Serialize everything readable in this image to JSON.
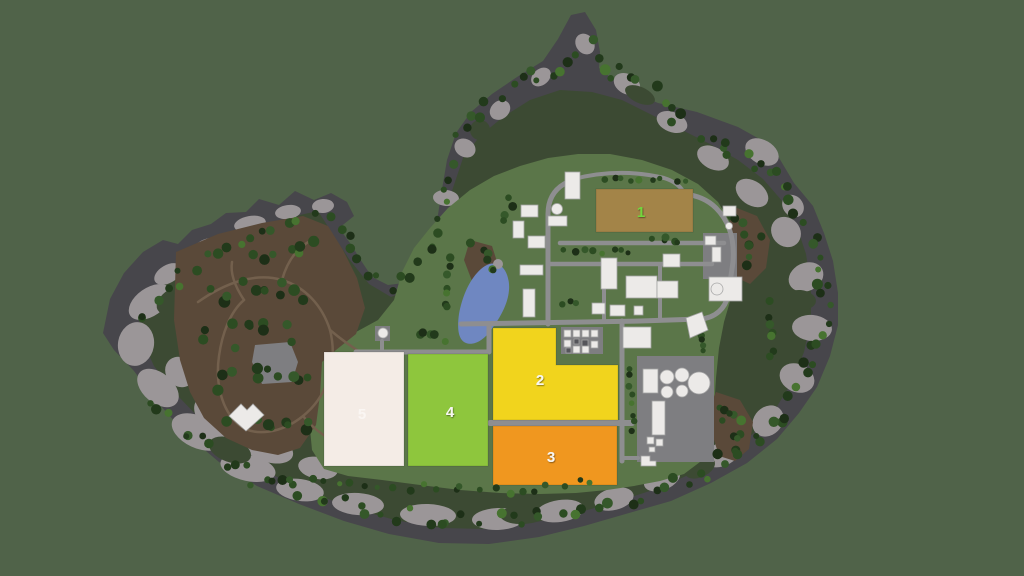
{
  "fields": [
    {
      "label": "1",
      "color": "#a38448",
      "label_color": "#72d63e"
    },
    {
      "label": "2",
      "color": "#f1d41d",
      "label_color": "#f7f6f2"
    },
    {
      "label": "3",
      "color": "#f0971f",
      "label_color": "#f7f6f2"
    },
    {
      "label": "4",
      "color": "#8ec63d",
      "label_color": "#f7f6f2"
    },
    {
      "label": "5",
      "color": "#f4ece6",
      "label_color": "#ffffff"
    }
  ],
  "colors": {
    "background": "#506349",
    "rock_dark": "#47464b",
    "rock_light": "#9b9698",
    "forest": "#3c4a33",
    "grass": "#5b7649",
    "dirt": "#5a4939",
    "trail": "#73604d",
    "road": "#8e8e90",
    "concrete": "#7e7e81",
    "water": "#6f87c1",
    "building": "#eceae8",
    "trees": [
      "#223a1b",
      "#2c4c22",
      "#1d2f17",
      "#35582a",
      "#2c4c22",
      "#223a1b",
      "#477330"
    ]
  }
}
